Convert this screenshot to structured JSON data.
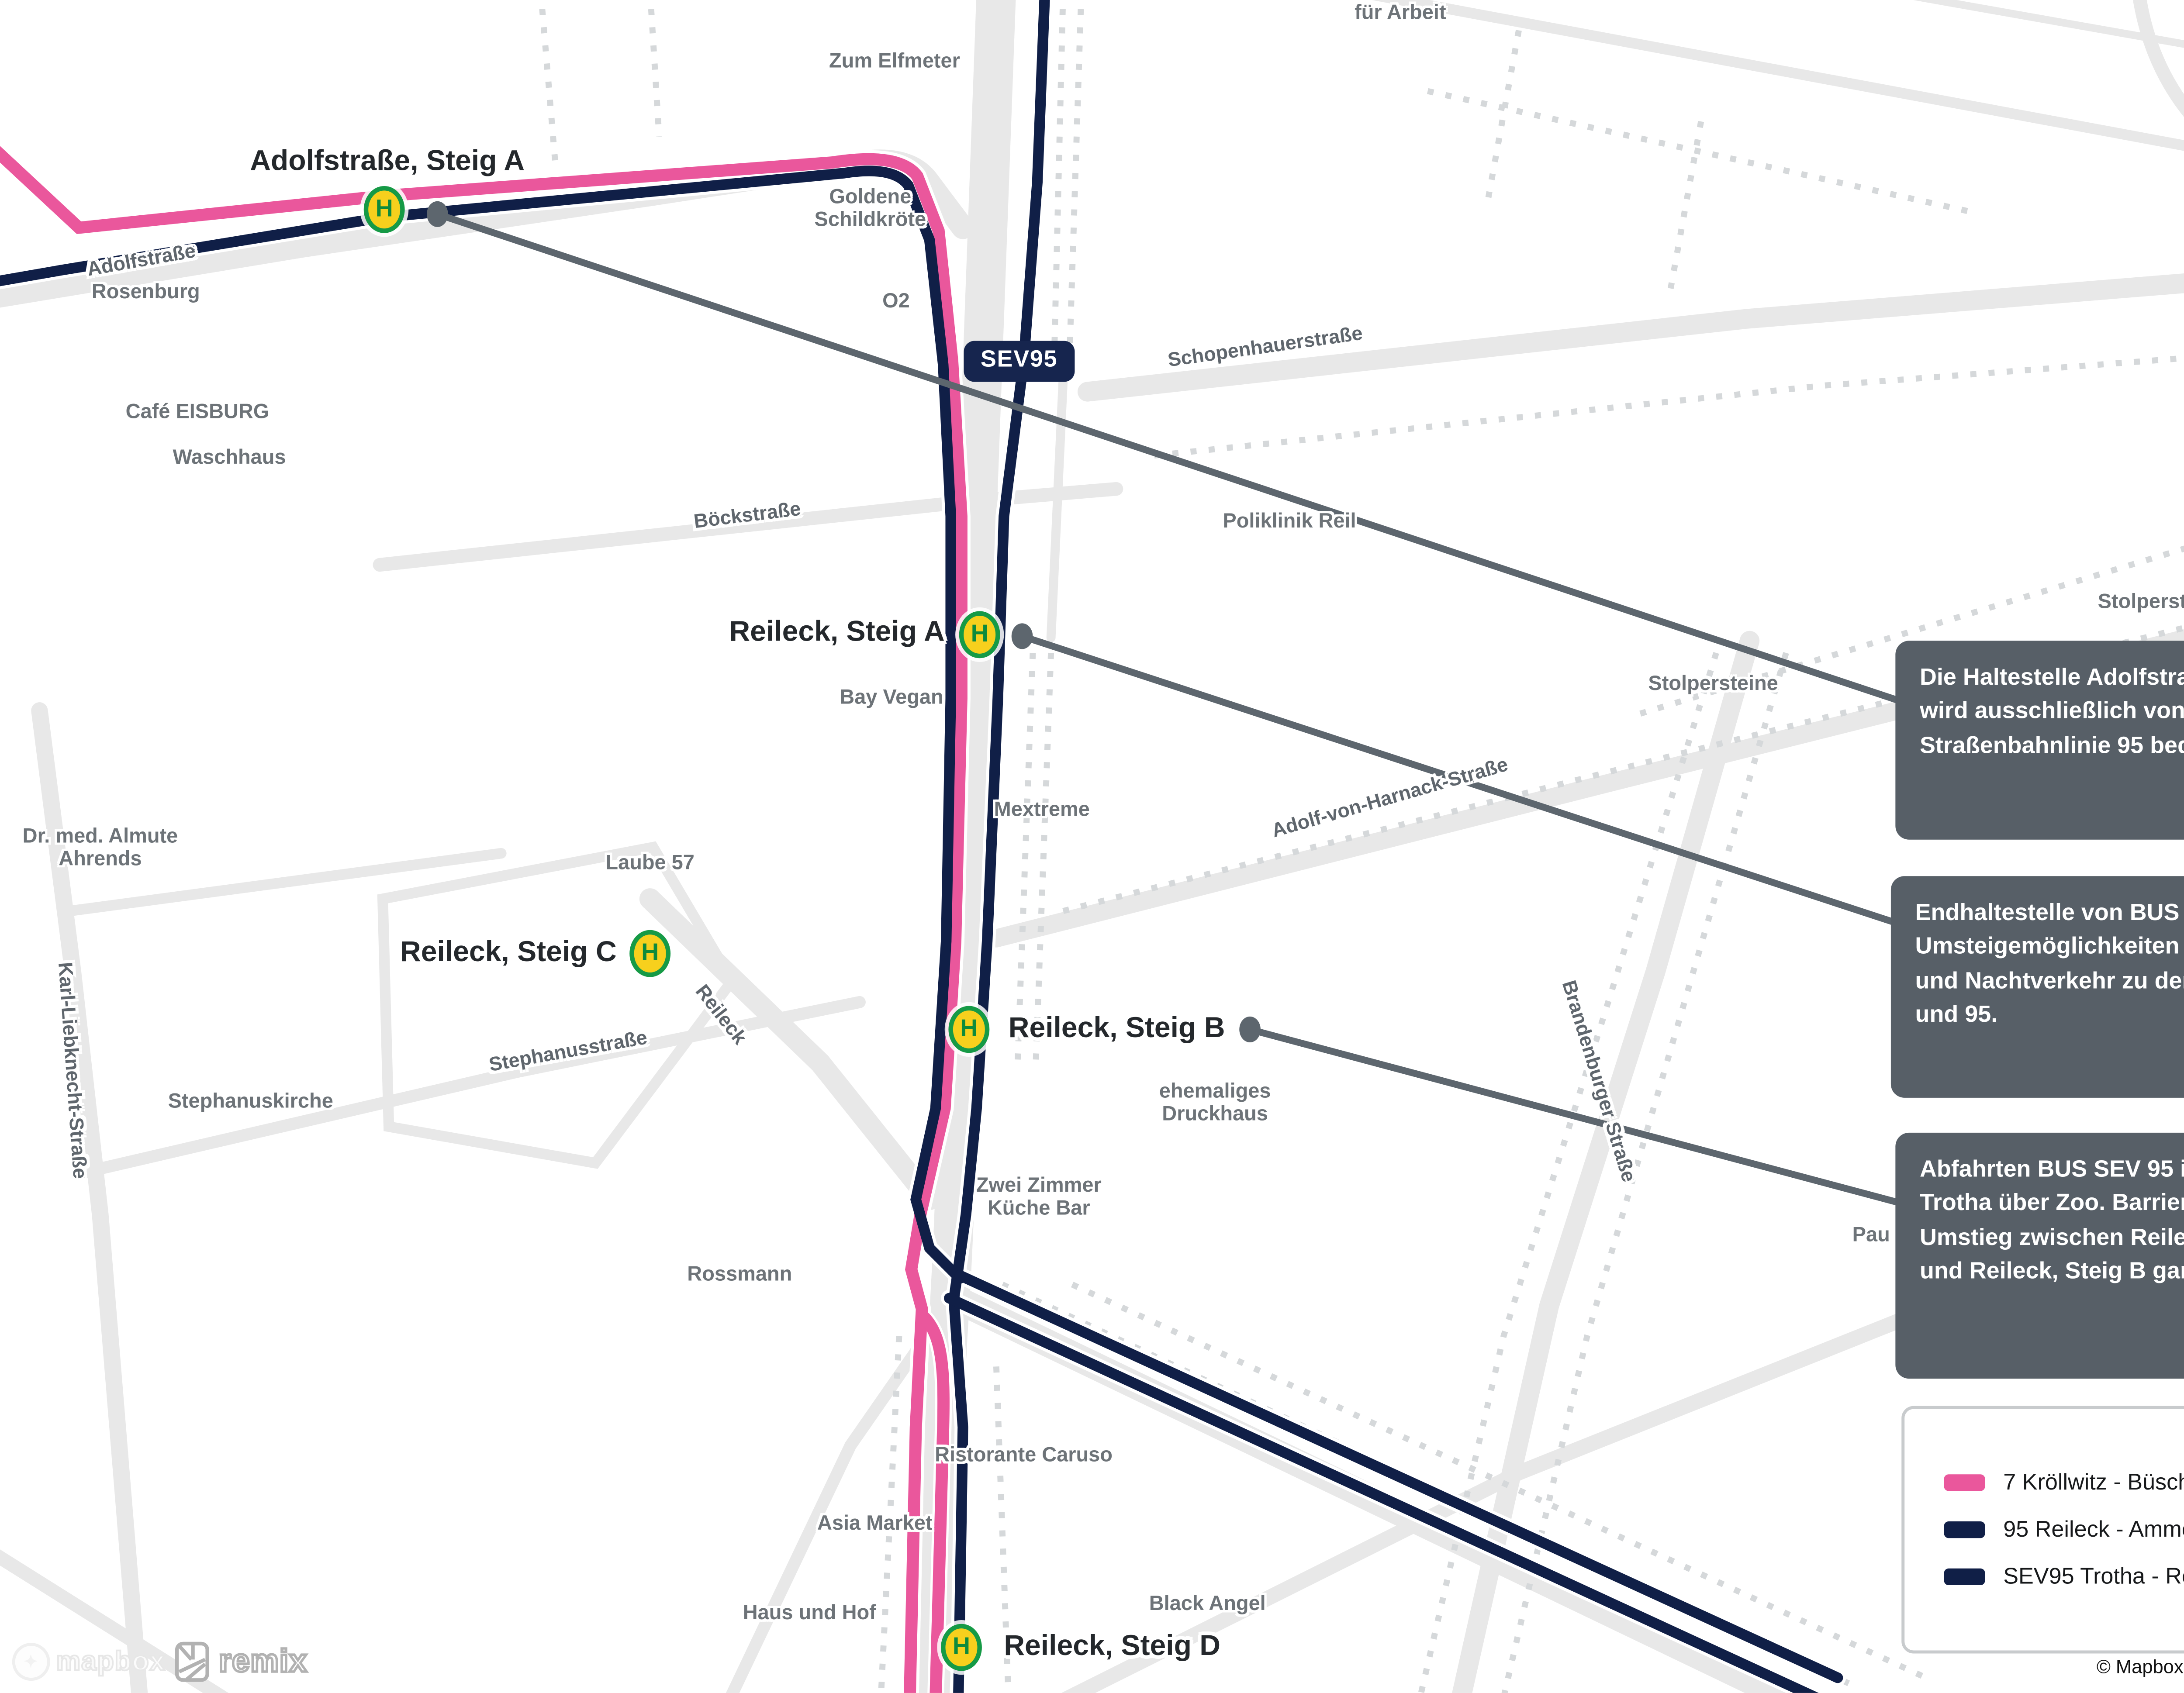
{
  "map": {
    "marker_letter": "H",
    "badge": "SEV95",
    "stops": [
      {
        "label": "Adolfstraße, Steig A"
      },
      {
        "label": "Reileck, Steig A"
      },
      {
        "label": "Reileck, Steig B"
      },
      {
        "label": "Reileck, Steig C"
      },
      {
        "label": "Reileck, Steig D"
      }
    ],
    "streets": [
      {
        "text": "Adolfstraße"
      },
      {
        "text": "Schopenhauerstraße"
      },
      {
        "text": "Böckstraße"
      },
      {
        "text": "Adolf-von-Harnack-Straße"
      },
      {
        "text": "Karl-Liebknecht-Straße"
      },
      {
        "text": "Stephanusstraße"
      },
      {
        "text": "Reileck"
      },
      {
        "text": "Brandenburger Straße"
      }
    ],
    "pois": [
      {
        "text": "Zum Elfmeter"
      },
      {
        "text": "Goldene\nSchildkröte"
      },
      {
        "text": "O2"
      },
      {
        "text": "Steinecke"
      },
      {
        "text": "für Arbeit"
      },
      {
        "text": "Rosenburg"
      },
      {
        "text": "Café EISBURG"
      },
      {
        "text": "Waschhaus"
      },
      {
        "text": "Poliklinik Reil"
      },
      {
        "text": "Stolpersteine"
      },
      {
        "text": "Stolpersteine"
      },
      {
        "text": "Bay Vegan"
      },
      {
        "text": "Mextreme"
      },
      {
        "text": "Dr. med. Almute\nAhrends"
      },
      {
        "text": "Laube 57"
      },
      {
        "text": "Stephanuskirche"
      },
      {
        "text": "ehemaliges\nDruckhaus"
      },
      {
        "text": "Zwei Zimmer\nKüche Bar"
      },
      {
        "text": "Rossmann"
      },
      {
        "text": "Ristorante Caruso"
      },
      {
        "text": "Asia Market"
      },
      {
        "text": "Haus und Hof"
      },
      {
        "text": "Black Angel"
      },
      {
        "text": "Pau"
      },
      {
        "text": "Kro"
      }
    ]
  },
  "annotations": [
    {
      "text": "Die Haltestelle Adolfstraße, Steig A wird ausschließlich von der Straßenbahnlinie 95 bedient."
    },
    {
      "text": "Endhaltestelle von BUS SEV 95. Umsteigemöglichkeiten im Spät- und Nachtverkehr zu den Linien 7 und 95."
    },
    {
      "text": "Abfahrten BUS SEV 95 in Richtung Trotha über Zoo. Barrierefreier Umstieg zwischen Reileck, Steig C und Reileck, Steig B garantiert."
    }
  ],
  "legend": {
    "items": [
      {
        "label": "7 Kröllwitz - Büschdorf",
        "color": "#ea579c"
      },
      {
        "label": "95 Reileck - Ammendorf",
        "color": "#101f47"
      },
      {
        "label": "SEV95 Trotha - Reileck",
        "color": "#101f47"
      }
    ]
  },
  "attribution": "© Mapbox © OpenStreetMap",
  "logos": {
    "mapbox": "mapbox",
    "remix": "remix"
  },
  "colors": {
    "line7_pink": "#ea579c",
    "line95_navy": "#101f47",
    "leader_gray": "#5d666e",
    "annotation_bg": "#575f67",
    "road_gray": "#e8e8e8",
    "road_dash_gray": "#d5d8da",
    "marker_fill_yellow": "#f7d01d",
    "marker_ring_green": "#169a46"
  }
}
